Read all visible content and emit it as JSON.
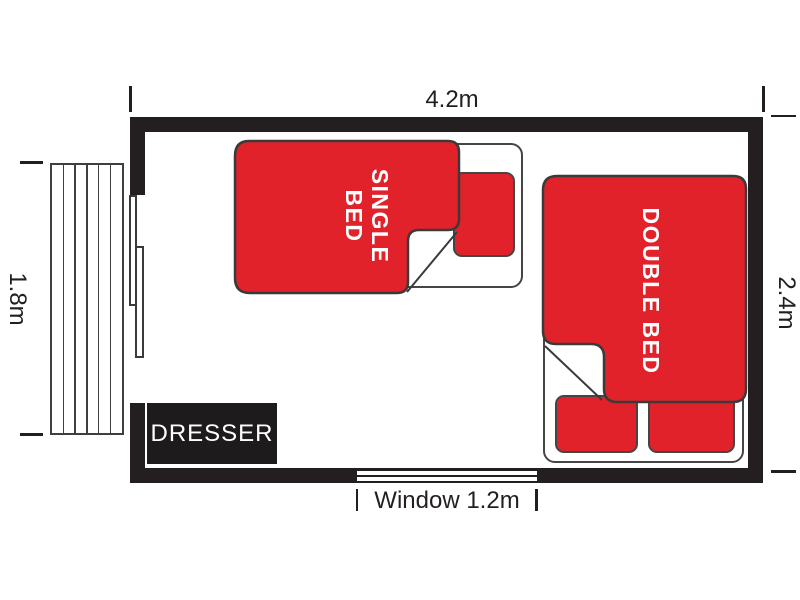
{
  "plan": {
    "dimensions": {
      "top": "4.2m",
      "left": "1.8m",
      "right": "2.4m",
      "window": "Window 1.2m"
    },
    "furniture": {
      "single_bed": "SINGLE\nBED",
      "double_bed": "DOUBLE BED",
      "dresser": "DRESSER"
    }
  },
  "colors": {
    "bed_red": "#e2222a",
    "wall": "#231f20",
    "outline": "#454545"
  }
}
